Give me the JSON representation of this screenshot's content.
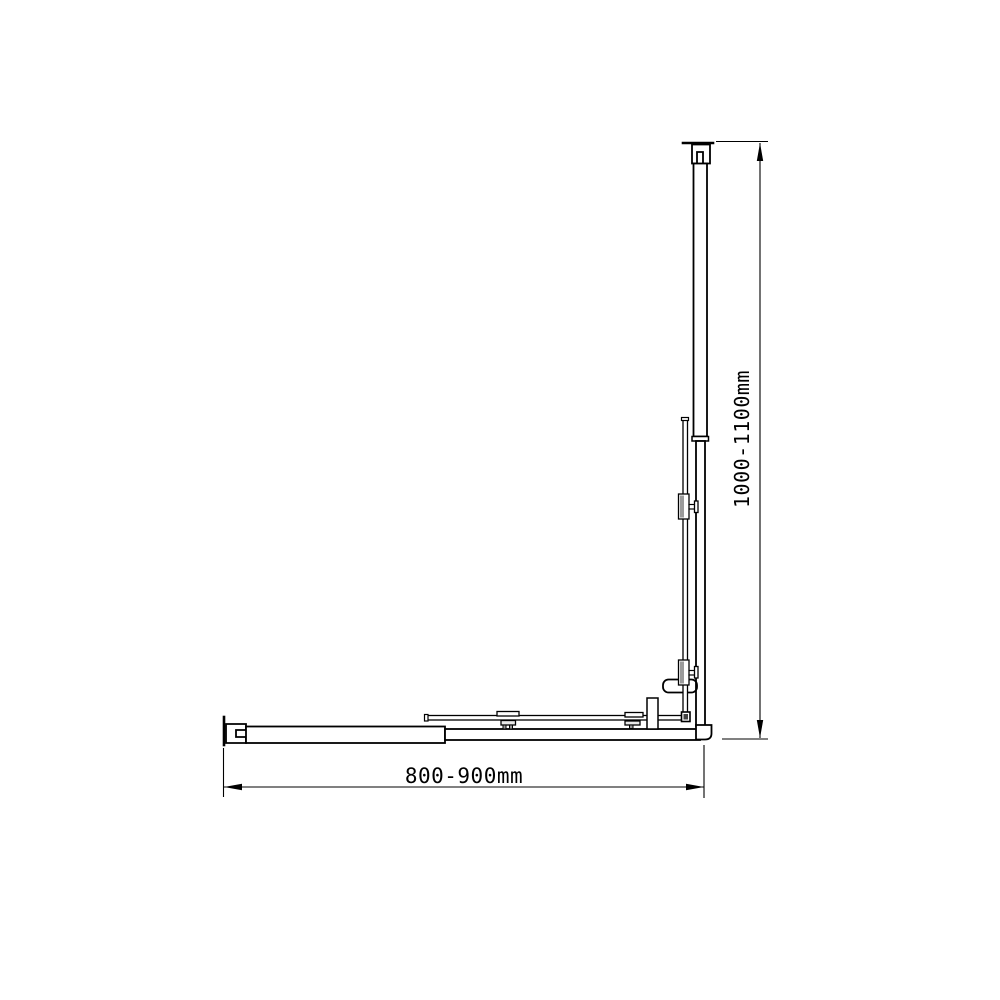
{
  "drawing": {
    "description": "Technical line drawing of an adjustable L-shaped shower screen frame: vertical telescopic rail with top wall bracket and corner foot, horizontal telescopic rail with left wall bracket, L-shaped stabilizer rod with clamps, handle knob and support post near the corner",
    "view": "front elevation",
    "colors": {
      "background": "#ffffff",
      "line": "#000000",
      "clamp_gray": "#9b9b9b",
      "plate_gray": "#e8e8e8"
    },
    "dimensions": {
      "vertical": {
        "label": "1000-1100mm",
        "min_mm": 1000,
        "max_mm": 1100,
        "orientation": "vertical"
      },
      "horizontal": {
        "label": "800-900mm",
        "min_mm": 800,
        "max_mm": 900,
        "orientation": "horizontal"
      }
    }
  }
}
